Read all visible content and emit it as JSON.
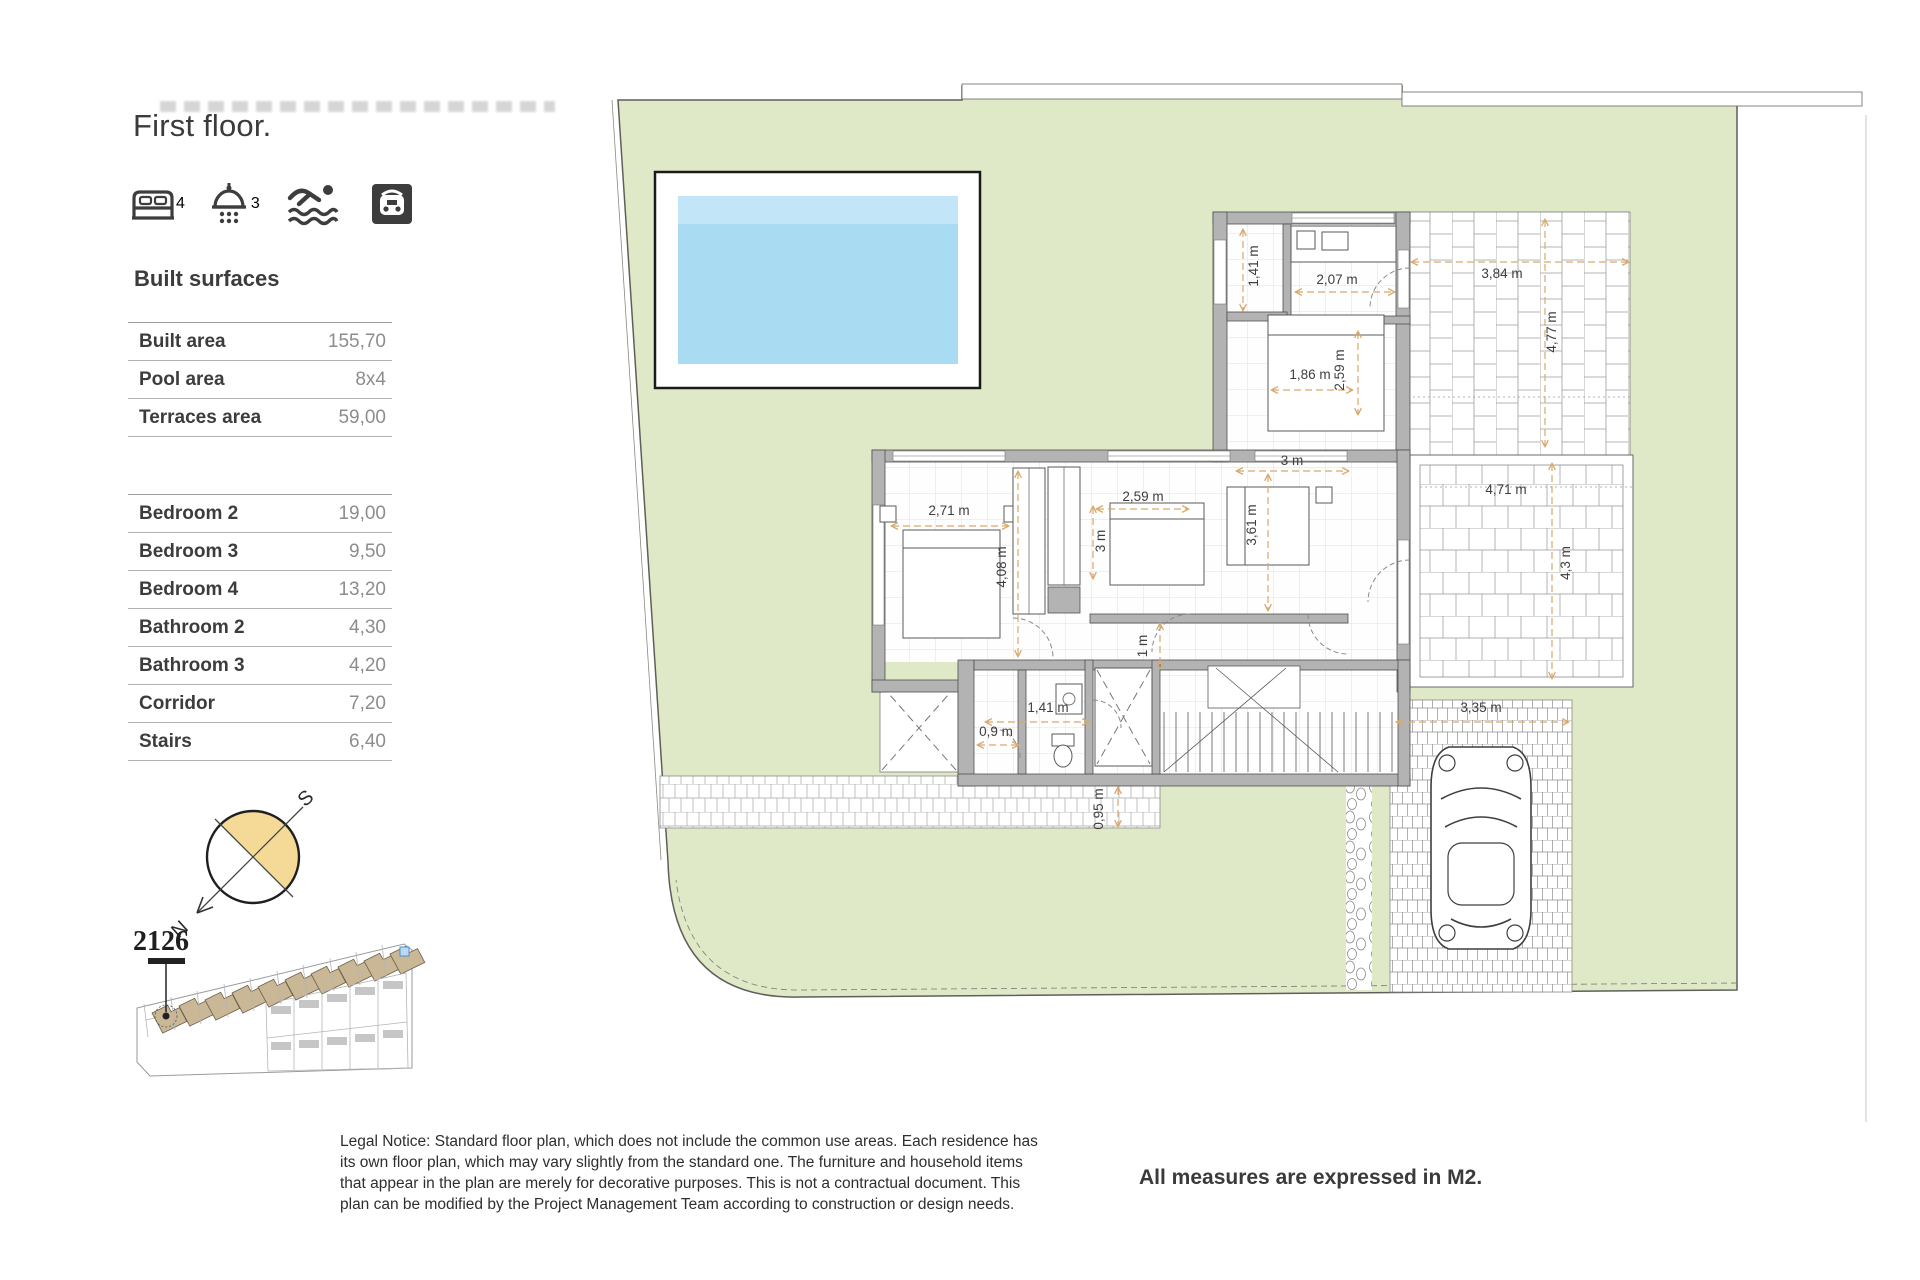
{
  "page": {
    "title": "First floor.",
    "measures_note": "All measures are expressed in M2.",
    "legal_notice": "Legal Notice: Standard floor plan, which does not include the common use areas. Each residence has its own floor plan, which may vary slightly from the standard one. The furniture and household items that appear in the plan are merely for decorative purposes. This is not a contractual document. This plan can be modified by the Project Management Team according to construction or design needs."
  },
  "features": [
    {
      "icon": "bed-icon",
      "count": "4"
    },
    {
      "icon": "shower-icon",
      "count": "3"
    },
    {
      "icon": "swim-icon",
      "count": ""
    },
    {
      "icon": "garage-icon",
      "count": ""
    }
  ],
  "built_surfaces": {
    "heading": "Built surfaces",
    "rows": [
      {
        "label": "Built area",
        "value": "155,70"
      },
      {
        "label": "Pool area",
        "value": "8x4"
      },
      {
        "label": "Terraces area",
        "value": "59,00"
      }
    ]
  },
  "rooms": {
    "rows": [
      {
        "label": "Bedroom 2",
        "value": "19,00"
      },
      {
        "label": "Bedroom 3",
        "value": "9,50"
      },
      {
        "label": "Bedroom 4",
        "value": "13,20"
      },
      {
        "label": "Bathroom 2",
        "value": "4,30"
      },
      {
        "label": "Bathroom 3",
        "value": "4,20"
      },
      {
        "label": "Corridor",
        "value": "7,20"
      },
      {
        "label": "Stairs",
        "value": "6,40"
      }
    ]
  },
  "compass": {
    "south_label": "S",
    "north_label": "N"
  },
  "site_plan": {
    "unit_number": "2126",
    "houses": [
      {
        "x": 152,
        "y": 1013
      },
      {
        "x": 179,
        "y": 1006
      },
      {
        "x": 205,
        "y": 1000
      },
      {
        "x": 232,
        "y": 993
      },
      {
        "x": 258,
        "y": 987
      },
      {
        "x": 285,
        "y": 980
      },
      {
        "x": 311,
        "y": 974
      },
      {
        "x": 338,
        "y": 967
      },
      {
        "x": 364,
        "y": 961
      },
      {
        "x": 390,
        "y": 954
      }
    ]
  },
  "floor_plan": {
    "dimensions": [
      {
        "text": "1,41 m",
        "x": 1258,
        "y": 266,
        "rot": -90
      },
      {
        "text": "2,07 m",
        "x": 1337,
        "y": 284,
        "rot": 0
      },
      {
        "text": "3,84 m",
        "x": 1502,
        "y": 278,
        "rot": 0
      },
      {
        "text": "4,77 m",
        "x": 1556,
        "y": 332,
        "rot": -90
      },
      {
        "text": "1,86 m",
        "x": 1310,
        "y": 379,
        "rot": 0
      },
      {
        "text": "2,59 m",
        "x": 1344,
        "y": 370,
        "rot": -90
      },
      {
        "text": "3 m",
        "x": 1292,
        "y": 465,
        "rot": 0
      },
      {
        "text": "2,71 m",
        "x": 949,
        "y": 515,
        "rot": 0
      },
      {
        "text": "2,59 m",
        "x": 1143,
        "y": 501,
        "rot": 0
      },
      {
        "text": "3 m",
        "x": 1105,
        "y": 541,
        "rot": -90
      },
      {
        "text": "4,08 m",
        "x": 1006,
        "y": 567,
        "rot": -90
      },
      {
        "text": "3,61 m",
        "x": 1256,
        "y": 525,
        "rot": -90
      },
      {
        "text": "1 m",
        "x": 1147,
        "y": 646,
        "rot": -90
      },
      {
        "text": "1,41 m",
        "x": 1048,
        "y": 712,
        "rot": 0
      },
      {
        "text": "0,9 m",
        "x": 996,
        "y": 736,
        "rot": 0
      },
      {
        "text": "0,95 m",
        "x": 1103,
        "y": 809,
        "rot": -90
      },
      {
        "text": "4,71 m",
        "x": 1506,
        "y": 494,
        "rot": 0
      },
      {
        "text": "4,3 m",
        "x": 1570,
        "y": 563,
        "rot": -90
      },
      {
        "text": "3,35 m",
        "x": 1481,
        "y": 712,
        "rot": 0
      }
    ]
  },
  "colors": {
    "plot_green": "#dfe9c8",
    "pool_blue": "#a9dbf2",
    "compass_fill": "#f4da96",
    "site_house_tan": "#c9b795",
    "dim_line": "#d9a96c"
  }
}
